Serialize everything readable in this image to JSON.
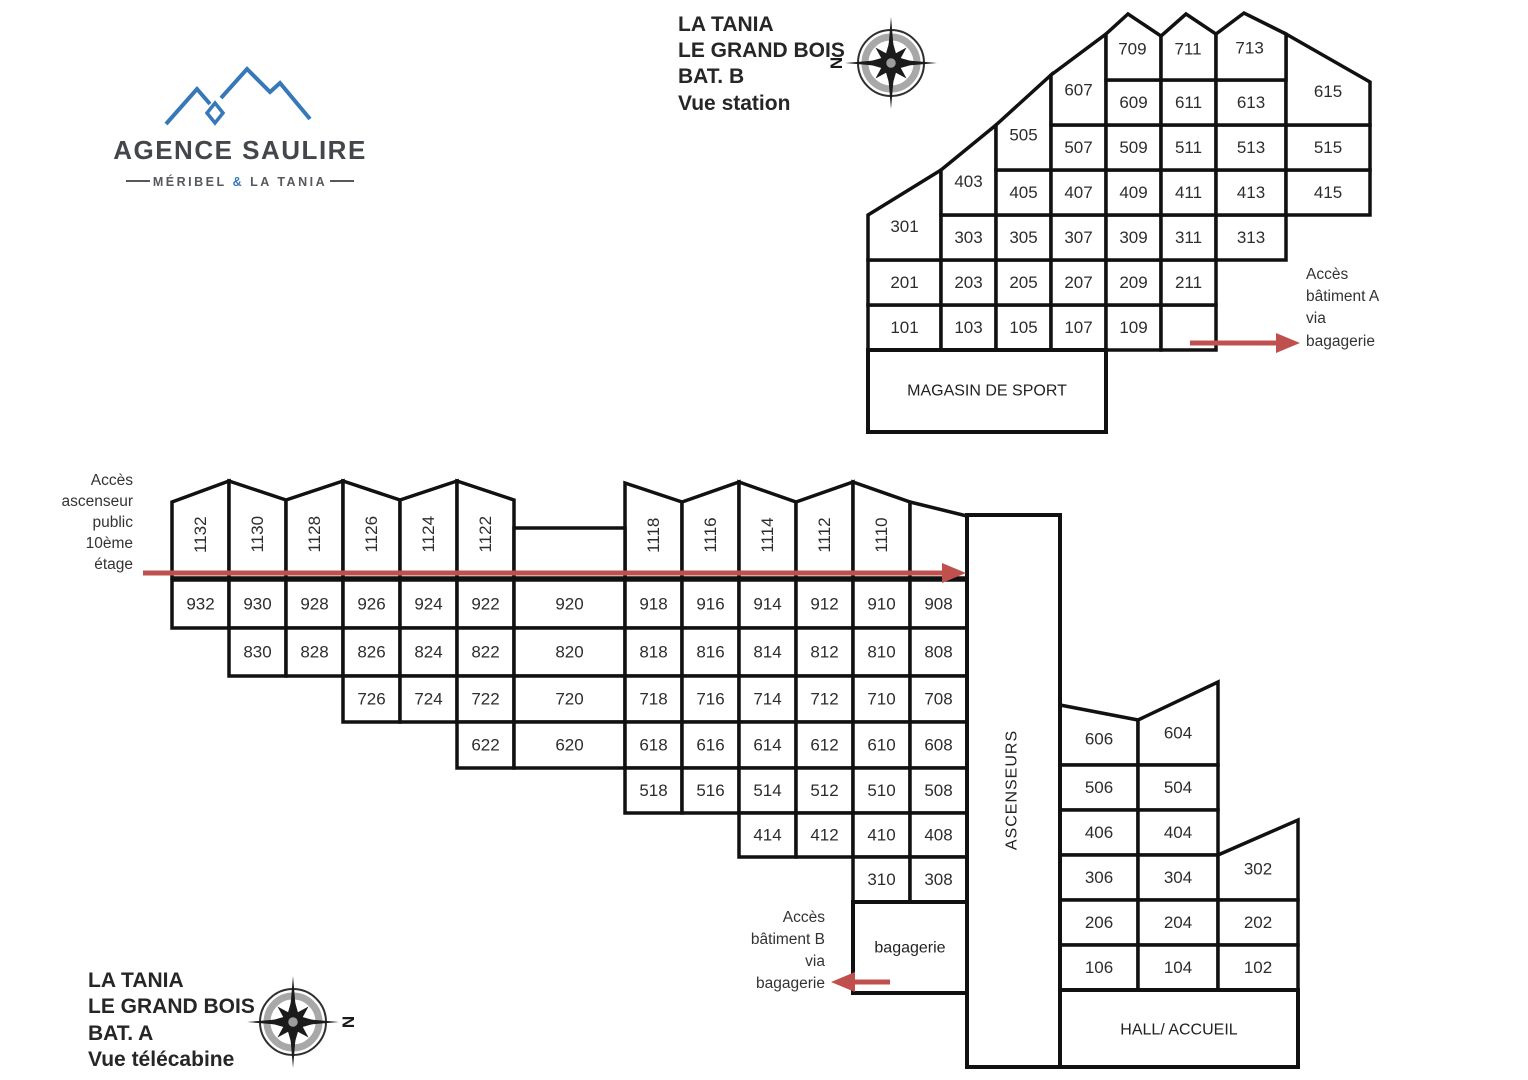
{
  "logo": {
    "name": "AGENCE SAULIRE",
    "subtitle_left": "MÉRIBEL",
    "subtitle_amp": "&",
    "subtitle_right": "LA TANIA"
  },
  "compass": {
    "north_label": "N"
  },
  "building_b": {
    "title_lines": [
      "LA TANIA",
      "LE GRAND BOIS",
      "BAT. B",
      "Vue station"
    ],
    "floors": [
      {
        "rooms": [
          "101",
          "103",
          "105",
          "107",
          "109",
          ""
        ]
      },
      {
        "rooms": [
          "201",
          "203",
          "205",
          "207",
          "209",
          "211"
        ]
      },
      {
        "rooms": [
          "301",
          "303",
          "305",
          "307",
          "309",
          "311",
          "313"
        ]
      },
      {
        "rooms": [
          "403",
          "405",
          "407",
          "409",
          "411",
          "413",
          "415"
        ]
      },
      {
        "rooms": [
          "505",
          "507",
          "509",
          "511",
          "513",
          "515"
        ]
      },
      {
        "rooms": [
          "607",
          "609",
          "611",
          "613",
          "615"
        ]
      },
      {
        "rooms": [
          "709",
          "711",
          "713"
        ]
      }
    ],
    "magasin_label": "MAGASIN DE SPORT",
    "access_note_lines": [
      "Accès",
      "bâtiment A",
      "via",
      "bagagerie"
    ]
  },
  "building_a": {
    "title_lines": [
      "LA TANIA",
      "LE GRAND BOIS",
      "BAT. A",
      "Vue télécabine"
    ],
    "top_floor_rooms": [
      "1132",
      "1130",
      "1128",
      "1126",
      "1124",
      "1122",
      "1118",
      "1116",
      "1114",
      "1112",
      "1110"
    ],
    "floors_left": [
      {
        "rooms": [
          "932",
          "930",
          "928",
          "926",
          "924",
          "922",
          "920",
          "918",
          "916",
          "914",
          "912",
          "910",
          "908"
        ]
      },
      {
        "rooms": [
          "830",
          "828",
          "826",
          "824",
          "822",
          "820",
          "818",
          "816",
          "814",
          "812",
          "810",
          "808"
        ]
      },
      {
        "rooms": [
          "726",
          "724",
          "722",
          "720",
          "718",
          "716",
          "714",
          "712",
          "710",
          "708"
        ]
      },
      {
        "rooms": [
          "622",
          "620",
          "618",
          "616",
          "614",
          "612",
          "610",
          "608"
        ]
      },
      {
        "rooms": [
          "518",
          "516",
          "514",
          "512",
          "510",
          "508"
        ]
      },
      {
        "rooms": [
          "414",
          "412",
          "410",
          "408"
        ]
      },
      {
        "rooms": [
          "310",
          "308"
        ]
      }
    ],
    "floors_right": [
      {
        "rooms": [
          "606",
          "604"
        ]
      },
      {
        "rooms": [
          "506",
          "504"
        ]
      },
      {
        "rooms": [
          "406",
          "404"
        ]
      },
      {
        "rooms": [
          "306",
          "304",
          "302"
        ]
      },
      {
        "rooms": [
          "206",
          "204",
          "202"
        ]
      },
      {
        "rooms": [
          "106",
          "104",
          "102"
        ]
      }
    ],
    "ascenseurs_label": "ASCENSEURS",
    "bagagerie_label": "bagagerie",
    "hall_label": "HALL/ ACCUEIL",
    "elevator_note_lines": [
      "Accès",
      "ascenseur",
      "public",
      "10ème",
      "étage"
    ],
    "access_note_lines": [
      "Accès",
      "bâtiment B",
      "via",
      "bagagerie"
    ]
  },
  "colors": {
    "line": "#111111",
    "arrow": "#c0504d",
    "logo_blue": "#3778b9",
    "room_text": "#2d2d2d"
  }
}
